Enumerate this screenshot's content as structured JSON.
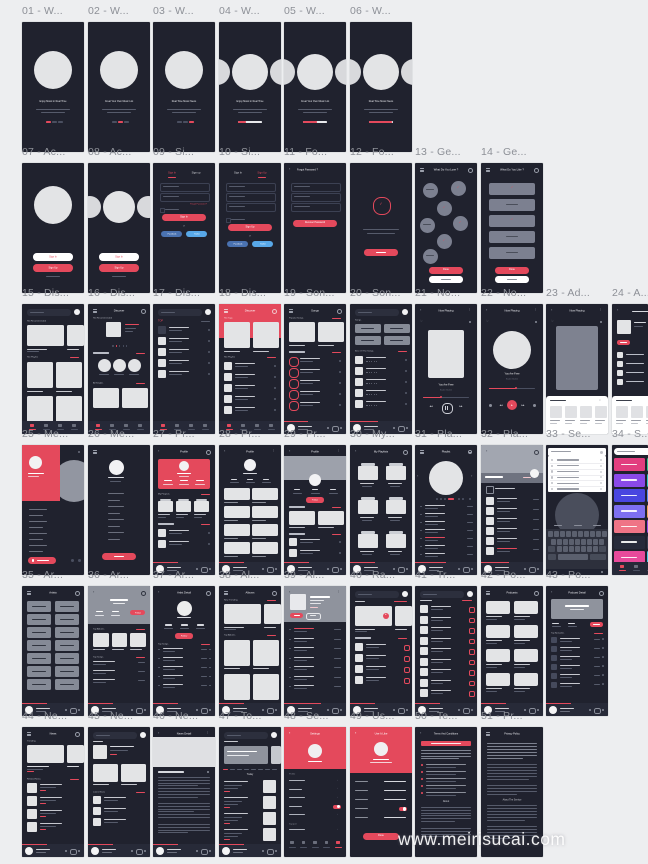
{
  "canvas": {
    "width": 648,
    "height": 864,
    "bg": "#edeef0"
  },
  "watermark": {
    "text": "www.meirisucai.com"
  },
  "colors": {
    "board": "#20222e",
    "red": "#e4495c",
    "light": "#e3e4e6",
    "lighter": "#f2f2f4",
    "mid": "#7c8090",
    "banner": "#8f939d",
    "dim": "#565b6b",
    "dim2": "#3c4153",
    "white": "#ffffff",
    "textlight": "#c9ccd4",
    "fb": "#4a72b0",
    "tw": "#58a8e8",
    "playerbg": "#272a38",
    "kbbg": "#2d303c",
    "key": "#5b606e",
    "tiles_left": [
      "#e23e7f",
      "#8a49e8",
      "#4946e0",
      "#7d6ff0",
      "#ef7486",
      "#262a3a",
      "#e84a9b"
    ],
    "tiles_right": [
      "#35c98f",
      "#2fc9c0",
      "#5a8df0",
      "#f0a35a",
      "#9a49e8",
      "#3a3f52",
      "#49c9e8"
    ]
  },
  "grid": {
    "xs": [
      22,
      88,
      153,
      219,
      284,
      350,
      415,
      481,
      546,
      612
    ],
    "board_w": 62,
    "board_h": 130,
    "label_dy": -17,
    "clip_w": 36
  },
  "rows": [
    {
      "y": 22,
      "boards": [
        {
          "label": "01 - W...",
          "kind": "walk",
          "p": {
            "title": "Enjoy Music in Real Time",
            "variant": "single",
            "active": 0
          }
        },
        {
          "label": "02 - W...",
          "kind": "walk",
          "p": {
            "title": "Creat Your Own Music List",
            "variant": "single",
            "active": 1
          }
        },
        {
          "label": "03 - W...",
          "kind": "walk",
          "p": {
            "title": "Real Time Music News",
            "variant": "single",
            "active": 2
          }
        },
        {
          "label": "04 - W...",
          "kind": "walk",
          "p": {
            "title": "Enjoy Music in Real Time",
            "variant": "multi",
            "progress": 0.35
          }
        },
        {
          "label": "05 - W...",
          "kind": "walk",
          "p": {
            "title": "Creat Your Own Music List",
            "variant": "multi",
            "progress": 0.6
          }
        },
        {
          "label": "06 - W...",
          "kind": "walk",
          "p": {
            "title": "Real Time Music News",
            "variant": "multi",
            "progress": 0.95
          }
        }
      ]
    },
    {
      "y": 163,
      "boards": [
        {
          "label": "07 - Ac...",
          "kind": "welcome",
          "p": {
            "variant": "single",
            "signin": "Sign In",
            "signup": "Sign Up"
          }
        },
        {
          "label": "08 - Ac...",
          "kind": "welcome",
          "p": {
            "variant": "multi",
            "signin": "Sign In",
            "signup": "Sign Up"
          }
        },
        {
          "label": "09 - Si...",
          "kind": "signin",
          "p": {
            "tab1": "Sign In",
            "tab2": "Sign up",
            "active": 0,
            "fields": 2,
            "btn": "Sign In",
            "forgot": "Forgot Password ?",
            "or": "or",
            "fb": "Facebook",
            "tw": "Twitter"
          }
        },
        {
          "label": "10 - Si...",
          "kind": "signin",
          "p": {
            "tab1": "Sign In",
            "tab2": "Sign Up",
            "active": 1,
            "fields": 3,
            "btn": "Sign Up",
            "or": "or",
            "fb": "Facebook",
            "tw": "Twitter"
          }
        },
        {
          "label": "11 - Fo...",
          "kind": "forgot",
          "p": {
            "title": "Forgot Password ?",
            "btn": "Recover Password"
          }
        },
        {
          "label": "12 - Fo...",
          "kind": "confirm",
          "p": {}
        },
        {
          "label": "13 - Ge...",
          "kind": "gcircles",
          "p": {
            "title": "What Do You Love ?",
            "done": "Done"
          }
        },
        {
          "label": "14 - Ge...",
          "kind": "gbars",
          "p": {
            "title": "What Do You Like ?",
            "done": "Done"
          }
        }
      ]
    },
    {
      "y": 304,
      "boards": [
        {
          "label": "15 - Dis...",
          "kind": "disc_a",
          "p": {
            "sec1": "Hot Recommended",
            "sec2": "Hot Playlist"
          }
        },
        {
          "label": "16 - Dis...",
          "kind": "disc_b",
          "p": {
            "title": "Discover",
            "sec1": "Hot Recommended",
            "sec3": "All Singles"
          }
        },
        {
          "label": "17 - Dis...",
          "kind": "disc_c",
          "p": {
            "top": "TOP"
          }
        },
        {
          "label": "18 - Dis...",
          "kind": "disc_d",
          "p": {
            "title": "Discover",
            "sec1": "Hot Tags",
            "sec2": "Hot Playlist"
          }
        },
        {
          "label": "19 - Son...",
          "kind": "songs_a",
          "p": {
            "title": "Songs",
            "sec1": "Popular Songs"
          }
        },
        {
          "label": "20 - Son...",
          "kind": "songs_b",
          "p": {
            "sec1": "Songs",
            "sec2": "Best Of The Songs"
          }
        },
        {
          "label": "21 - No...",
          "kind": "np_a",
          "p": {
            "title": "Now Playing",
            "song": "You Are Free",
            "artist": "Baden Baden"
          }
        },
        {
          "label": "22 - No...",
          "kind": "np_b",
          "p": {
            "title": "Now Playing",
            "song": "You Are Free",
            "artist": "Baden Baden"
          }
        },
        {
          "label": "23 - Ad...",
          "kind": "np_c",
          "p": {
            "title": "Now Playing"
          }
        },
        {
          "label": "24 - A...",
          "kind": "addpl",
          "clip": true,
          "p": {}
        }
      ]
    },
    {
      "y": 445,
      "boards": [
        {
          "label": "25 - Me...",
          "kind": "menu_red",
          "p": {}
        },
        {
          "label": "26 - Me...",
          "kind": "menu_dark",
          "p": {}
        },
        {
          "label": "27 - Pr...",
          "kind": "prof_red",
          "p": {
            "title": "Profile",
            "sec1": "My Playlists"
          }
        },
        {
          "label": "28 - Pr...",
          "kind": "prof_grid",
          "p": {
            "title": "Profile"
          }
        },
        {
          "label": "29 - Pr...",
          "kind": "prof_banner",
          "p": {
            "title": "Profile",
            "follow": "Follow"
          }
        },
        {
          "label": "30 - My...",
          "kind": "folders",
          "p": {
            "title": "My Playlists"
          }
        },
        {
          "label": "31 - Pla...",
          "kind": "pl_circle",
          "p": {
            "title": "Playlist"
          }
        },
        {
          "label": "32 - Pla...",
          "kind": "pl_detail",
          "p": {}
        },
        {
          "label": "33 - Se...",
          "kind": "skbd",
          "p": {}
        },
        {
          "label": "34 - S...",
          "kind": "gcolors",
          "clip": true,
          "p": {}
        }
      ]
    },
    {
      "y": 586,
      "boards": [
        {
          "label": "35 - Ar...",
          "kind": "chips",
          "p": {
            "title": "Artists"
          }
        },
        {
          "label": "36 - Ar...",
          "kind": "art_a",
          "p": {
            "title": "Artist Detail",
            "follow": "Follow",
            "sec1": "Top Albums",
            "sec2": "Top Songs"
          }
        },
        {
          "label": "37 - Ar...",
          "kind": "art_b",
          "p": {
            "title": "Artist Detail",
            "follow": "Follow",
            "sec1": "Top Songs"
          }
        },
        {
          "label": "38 - Al...",
          "kind": "albums",
          "p": {
            "title": "Albums",
            "sec1": "New Trending",
            "sec2": "Top Albums"
          }
        },
        {
          "label": "39 - Al...",
          "kind": "album_d",
          "p": {
            "title": "Album Detail"
          }
        },
        {
          "label": "40 - Ra...",
          "kind": "radio",
          "p": {}
        },
        {
          "label": "41 - Tr...",
          "kind": "listing",
          "p": {}
        },
        {
          "label": "42 - Po...",
          "kind": "podcasts",
          "p": {
            "title": "Podcasts"
          }
        },
        {
          "label": "43 - Po...",
          "kind": "pod_d",
          "p": {
            "title": "Podcast Detail",
            "sec1": "Top Episodes"
          }
        }
      ]
    },
    {
      "y": 727,
      "boards": [
        {
          "label": "44 - Ne...",
          "kind": "news",
          "p": {
            "title": "News",
            "sec1": "Trending",
            "sec2": "Related News"
          }
        },
        {
          "label": "45 - Ne...",
          "kind": "news_b",
          "p": {
            "sec2": "Latest News"
          }
        },
        {
          "label": "46 - Ne...",
          "kind": "news_d",
          "p": {
            "title": "News Detail"
          }
        },
        {
          "label": "47 - To...",
          "kind": "today",
          "p": {
            "sec": "Today"
          }
        },
        {
          "label": "48 - Se...",
          "kind": "settings",
          "p": {
            "title": "Settings",
            "sec1": "Profile",
            "sec2": "Support"
          }
        },
        {
          "label": "49 - Us...",
          "kind": "useit",
          "p": {
            "title": "Use It Like",
            "done": "Done"
          }
        },
        {
          "label": "50 - Te...",
          "kind": "terms",
          "p": {
            "title": "Terms And Conditions",
            "about": "About"
          }
        },
        {
          "label": "51 - Pr...",
          "kind": "privacy",
          "p": {
            "title": "Privacy Policy",
            "about": "About The Service"
          }
        }
      ]
    }
  ]
}
